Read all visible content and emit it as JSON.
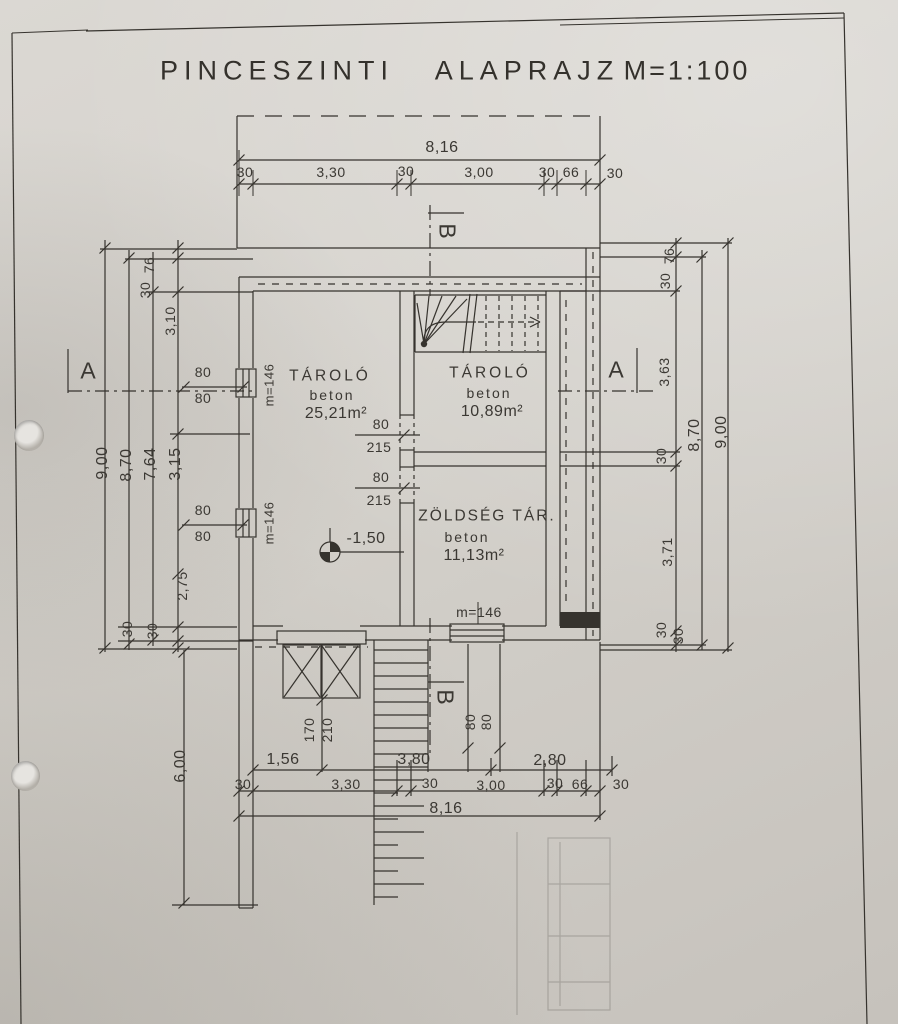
{
  "title": {
    "name": "PINCESZINTI",
    "type": "ALAPRAJZ",
    "scale": "M=1:100"
  },
  "rooms": [
    {
      "name": "TÁROLÓ",
      "material": "beton",
      "area": "25,21m²"
    },
    {
      "name": "TÁROLÓ",
      "material": "beton",
      "area": "10,89m²"
    },
    {
      "name": "ZÖLDSÉG TÁR.",
      "material": "beton",
      "area": "11,13m²"
    }
  ],
  "level": {
    "value": "-1,50"
  },
  "sections": {
    "a": "A",
    "b": "B"
  },
  "dims": {
    "top": {
      "total": "8,16",
      "chain": [
        "30",
        "3,30",
        "30",
        "3,00",
        "30",
        "66",
        "30"
      ]
    },
    "bottom": {
      "spans": [
        "1,56",
        "3,80",
        "2,80"
      ],
      "chain": [
        "30",
        "3,30",
        "30",
        "3,00",
        "30",
        "66",
        "30"
      ],
      "total": "8,16"
    },
    "left": {
      "v9": "9,00",
      "v87": "8,70",
      "v764": "7,64",
      "v315": "3,15",
      "v31": "3,10",
      "v76": "76",
      "v30a": "30",
      "v275": "2,75",
      "v30b": "30",
      "v30c": "30",
      "below": "6,00"
    },
    "right": {
      "v76": "76",
      "v30a": "30",
      "v363": "3,63",
      "v30b": "30",
      "v371": "3,71",
      "v30c": "30",
      "v30d": "30",
      "v87": "8,70",
      "v9": "9,00"
    }
  },
  "openings": {
    "window1": {
      "w": "80",
      "h": "80",
      "sill": "m=146"
    },
    "window2": {
      "w": "80",
      "h": "80",
      "sill": "m=146"
    },
    "door1": {
      "w": "80",
      "h": "215"
    },
    "door2": {
      "w": "80",
      "h": "215"
    },
    "garage": {
      "w": "170",
      "h": "210"
    },
    "window3": {
      "sill": "m=146",
      "w": "80",
      "h": "80"
    }
  }
}
